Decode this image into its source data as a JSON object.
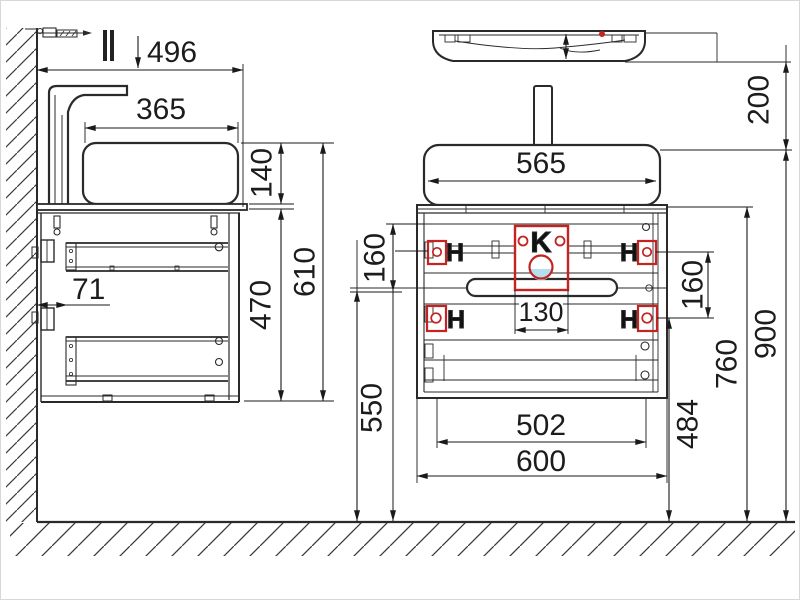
{
  "colors": {
    "line": "#2a2a2a",
    "dimension": "#1a1a1a",
    "highlight_red": "#c62222",
    "highlight_blue": "#b4e0ee",
    "background": "#ffffff"
  },
  "side_view": {
    "dims": {
      "total_depth": "496",
      "basin_depth": "365",
      "basin_height": "140",
      "total_height": "610",
      "cabinet_height": "470",
      "wall_offset": "71"
    }
  },
  "front_view": {
    "dims": {
      "basin_width": "565",
      "basin_drop": "200",
      "top_to_handle": "160",
      "hole_spacing": "160",
      "cutout_width": "130",
      "handle_to_floor": "550",
      "inner_width": "502",
      "cabinet_width": "600",
      "holes_to_floor": "484",
      "cabinet_to_floor": "760",
      "rim_to_floor": "900"
    },
    "markers": {
      "drain_label": "K",
      "hole_label": "H"
    }
  }
}
